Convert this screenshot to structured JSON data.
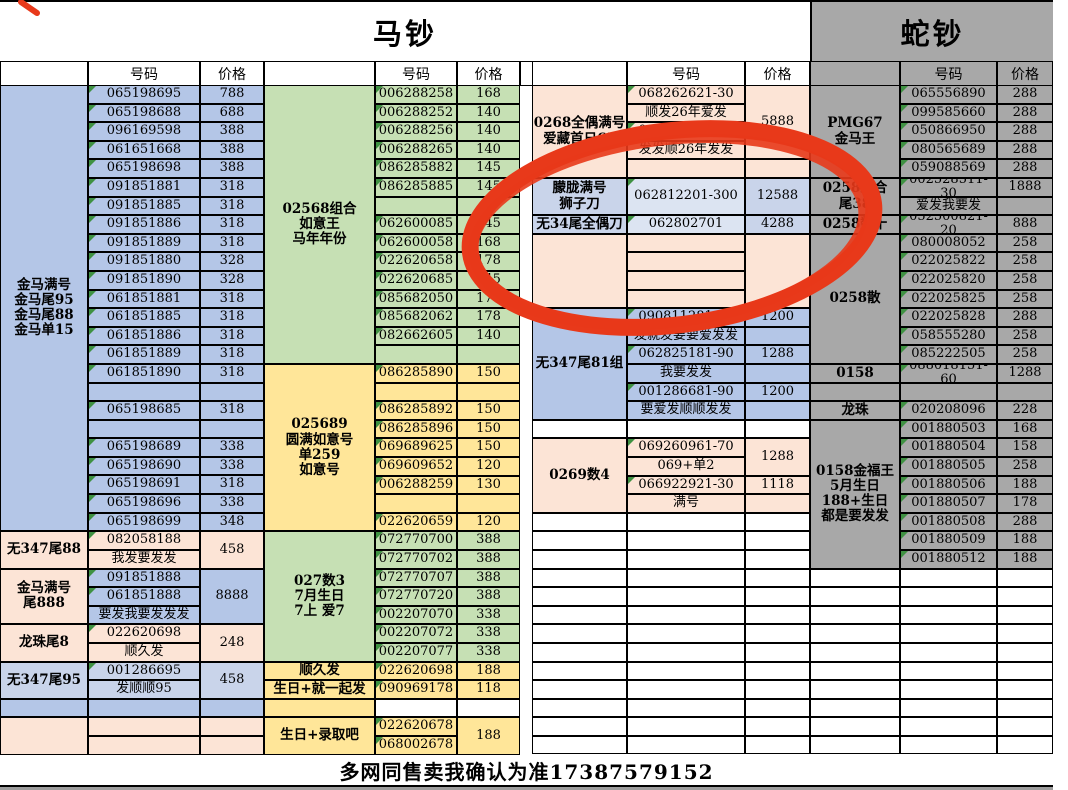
{
  "sheet": {
    "titles": {
      "horse": "马钞",
      "snake": "蛇钞"
    },
    "column_headers": {
      "number": "号码",
      "price": "价格"
    },
    "footer_note": "多网同售卖我确认为准17387579152",
    "annotation": {
      "type": "hand_drawn_red_circle",
      "color": "#e8391a"
    },
    "colors": {
      "blue": "#b4c6e7",
      "pale_blue": "#c9d4ea",
      "lighter_blue": "#dce4f2",
      "green": "#c6e0b4",
      "yellow": "#ffe699",
      "orange": "#fce4d6",
      "gray": "#a8a8a8",
      "marker_green": "#3f9142"
    },
    "groups": [
      {
        "id": "left",
        "widths": [
          88,
          112,
          64
        ],
        "blocks": [
          {
            "bg": "#b4c6e7",
            "label": [
              {
                "v": "金马满号\n金马尾95\n金马尾88\n金马单15",
                "s": 24
              }
            ],
            "num": [
              "065198695",
              "065198688",
              "096169598",
              "061651668",
              "065198698",
              "091851881",
              "091851885",
              "091851886",
              "091851889",
              "091851880",
              "091851890",
              "061851881",
              "061851885",
              "061851886",
              "061851889",
              "061851890",
              "",
              "065198685",
              "",
              "065198689",
              "065198690",
              "065198691",
              "065198696",
              "065198699"
            ],
            "price": [
              "788",
              "688",
              "388",
              "388",
              "388",
              "318",
              "318",
              "318",
              "318",
              "328",
              "328",
              "318",
              "318",
              "318",
              "318",
              "318",
              "",
              "318",
              "",
              "338",
              "338",
              "318",
              "338",
              "348"
            ]
          },
          {
            "bg": "#fce4d6",
            "label": [
              {
                "v": "无347尾88",
                "s": 2
              }
            ],
            "num": [
              "082058188",
              "我发要发发"
            ],
            "price": [
              {
                "v": "458",
                "s": 2
              }
            ]
          },
          {
            "bg": "#b4c6e7",
            "label": [
              {
                "v": "金马满号\n尾888",
                "s": 3,
                "bg": "#fce4d6"
              }
            ],
            "num": [
              "091851888",
              "061851888",
              "要发我要发发发"
            ],
            "price": [
              {
                "v": "8888",
                "s": 3
              }
            ]
          },
          {
            "bg": "#fce4d6",
            "label": [
              {
                "v": "龙珠尾8",
                "s": 2
              }
            ],
            "num": [
              "022620698",
              "顺久发"
            ],
            "price": [
              {
                "v": "248",
                "s": 2
              }
            ]
          },
          {
            "bg": "#c9d4ea",
            "label": [
              {
                "v": "无347尾95",
                "s": 2
              }
            ],
            "num": [
              "001286695",
              "发顺顺95"
            ],
            "price": [
              {
                "v": "458",
                "s": 2
              }
            ]
          },
          {
            "bg": "#b4c6e7",
            "label": [
              {
                "v": "",
                "s": 1
              }
            ],
            "num": [
              ""
            ],
            "price": [
              ""
            ]
          },
          {
            "bg": "#fce4d6",
            "label": [
              {
                "v": "",
                "s": 2
              }
            ],
            "num": [
              "",
              ""
            ],
            "price": [
              "",
              ""
            ]
          }
        ]
      },
      {
        "id": "mid-left",
        "widths": [
          111,
          82,
          63
        ],
        "blocks": [
          {
            "bg": "#c6e0b4",
            "label": [
              {
                "v": "02568组合\n如意王\n马年年份",
                "s": 15
              }
            ],
            "num": [
              "006288258",
              "006288252",
              "006288256",
              "006288265",
              "086285882",
              "086285885",
              "",
              "062600085",
              "062600058",
              "022620658",
              "022620685",
              "085682050",
              "085682062",
              "082662605",
              ""
            ],
            "price": [
              "168",
              "140",
              "140",
              "140",
              "145",
              "145",
              "",
              "145",
              "168",
              "178",
              "145",
              "178",
              "178",
              "140",
              ""
            ]
          },
          {
            "bg": "#ffe699",
            "label": [
              {
                "v": "025689\n圆满如意号\n单259\n如意号",
                "s": 9
              }
            ],
            "num": [
              "086285890",
              "",
              "086285892",
              "086285896",
              "069689625",
              "069609652",
              "006288259",
              "",
              "022620659"
            ],
            "price": [
              "150",
              "",
              "150",
              "150",
              "150",
              "120",
              "130",
              "",
              "120"
            ]
          },
          {
            "bg": "#c6e0b4",
            "label": [
              {
                "v": "027数3\n7月生日\n7上 爱7",
                "s": 7
              }
            ],
            "num": [
              "072770700",
              "072770702",
              "072770707",
              "072770720",
              "002207070",
              "002207072",
              "002207077"
            ],
            "price": [
              "388",
              "388",
              "388",
              "388",
              "338",
              "338",
              "338"
            ]
          },
          {
            "bg": "#ffe699",
            "label": [
              {
                "v": "顺久发",
                "s": 1
              }
            ],
            "num": [
              "022620698"
            ],
            "price": [
              "188"
            ]
          },
          {
            "bg": "#ffe699",
            "label": [
              {
                "v": "生日+就一起发",
                "s": 1
              }
            ],
            "num": [
              "090969178"
            ],
            "price": [
              "118"
            ]
          },
          {
            "bg": "#ffffff",
            "label": [
              {
                "v": "",
                "s": 1,
                "bg": "#ffe699"
              }
            ],
            "num": [
              ""
            ],
            "price": [
              ""
            ]
          },
          {
            "bg": "#ffe699",
            "label": [
              {
                "v": "生日+录取吧",
                "s": 2
              }
            ],
            "num": [
              "022620678",
              "068002678"
            ],
            "price": [
              {
                "v": "188",
                "s": 2
              }
            ]
          }
        ]
      },
      {
        "id": "middle",
        "widths": [
          95,
          118,
          65
        ],
        "blocks": [
          {
            "bg": "#fce4d6",
            "label": [
              {
                "v": "0268全偶满号\n爱藏首日65",
                "s": 5
              }
            ],
            "num": [
              "068262621-30",
              "顺发26年爱发",
              "068262721-30",
              "发发顺26年发发",
              ""
            ],
            "price": [
              {
                "v": "5888",
                "s": 4
              },
              {
                "v": "",
                "s": 1
              }
            ]
          },
          {
            "bg": "#c9d4ea",
            "label": [
              {
                "v": "朦胧满号\n狮子刀",
                "s": 2
              }
            ],
            "num": [
              {
                "v": "062812201-300",
                "s": 2,
                "bg": "#dce4f2"
              }
            ],
            "price": [
              {
                "v": "12588",
                "s": 2
              }
            ]
          },
          {
            "bg": "#c9d4ea",
            "label": [
              {
                "v": "无34尾全偶刀",
                "s": 1
              }
            ],
            "num": [
              {
                "v": "062802701",
                "bg": "#dce4f2"
              }
            ],
            "price": [
              "4288"
            ]
          },
          {
            "bg": "#fce4d6",
            "label": [
              {
                "v": "",
                "s": 4
              }
            ],
            "num": [
              "",
              "",
              "",
              ""
            ],
            "price": [
              {
                "v": "",
                "s": 4
              }
            ]
          },
          {
            "bg": "#b4c6e7",
            "label": [
              {
                "v": "无347尾81组",
                "s": 6
              }
            ],
            "num": [
              "090811281-90",
              "发就发要要爱发发",
              "062825181-90",
              "我要发发",
              "001286681-90",
              "要爱发顺顺发发"
            ],
            "price": [
              "1200",
              "",
              "1288",
              "",
              "1200",
              ""
            ]
          },
          {
            "bg": "#ffffff",
            "label": [
              {
                "v": "",
                "s": 1
              }
            ],
            "num": [
              ""
            ],
            "price": [
              ""
            ]
          },
          {
            "bg": "#fce4d6",
            "label": [
              {
                "v": "0269数4",
                "s": 4
              }
            ],
            "num": [
              "069260961-70",
              "069+单2",
              "066922921-30",
              "满号"
            ],
            "price": [
              {
                "v": "1288",
                "s": 2
              },
              {
                "v": "1118",
                "s": 1
              },
              {
                "v": "",
                "s": 1
              }
            ]
          },
          {
            "bg": "#ffffff",
            "label": [
              "",
              "",
              "",
              "",
              "",
              "",
              "",
              "",
              "",
              "",
              "",
              "",
              ""
            ],
            "num": [
              "",
              "",
              "",
              "",
              "",
              "",
              "",
              "",
              "",
              "",
              "",
              "",
              ""
            ],
            "price": [
              "",
              "",
              "",
              "",
              "",
              "",
              "",
              "",
              "",
              "",
              "",
              "",
              ""
            ]
          }
        ]
      },
      {
        "id": "right",
        "widths": [
          90,
          97,
          56
        ],
        "blocks": [
          {
            "bg": "#a8a8a8",
            "label": [
              {
                "v": "PMG67\n金马王",
                "s": 5
              }
            ],
            "num": [
              "065556890",
              "099585660",
              "050866950",
              "080565689",
              "059088569"
            ],
            "price": [
              "288",
              "288",
              "288",
              "288",
              "288"
            ]
          },
          {
            "bg": "#a8a8a8",
            "label": [
              {
                "v": "0258组合\n尾38",
                "s": 2
              }
            ],
            "num": [
              "002528511-30",
              "爱发我要发"
            ],
            "price": [
              "1888",
              ""
            ]
          },
          {
            "bg": "#a8a8a8",
            "label": [
              {
                "v": "0258数十",
                "s": 1
              }
            ],
            "num": [
              "052500821-20"
            ],
            "price": [
              "888"
            ]
          },
          {
            "bg": "#a8a8a8",
            "label": [
              {
                "v": "0258散",
                "s": 7
              }
            ],
            "num": [
              "080008052",
              "022025822",
              "022025820",
              "022025825",
              "022025828",
              "058555280",
              "085222505"
            ],
            "price": [
              "258",
              "258",
              "258",
              "258",
              "288",
              "258",
              "258"
            ]
          },
          {
            "bg": "#a8a8a8",
            "label": [
              {
                "v": "0158",
                "s": 1
              }
            ],
            "num": [
              "088018151-60"
            ],
            "price": [
              "1288"
            ]
          },
          {
            "bg": "#a8a8a8",
            "label": [
              {
                "v": "",
                "s": 1
              }
            ],
            "num": [
              ""
            ],
            "price": [
              ""
            ]
          },
          {
            "bg": "#a8a8a8",
            "label": [
              {
                "v": "龙珠",
                "s": 1
              }
            ],
            "num": [
              "020208096"
            ],
            "price": [
              "228"
            ]
          },
          {
            "bg": "#a8a8a8",
            "label": [
              {
                "v": "0158金福王\n5月生日\n188+生日\n都是要发发",
                "s": 8
              }
            ],
            "num": [
              "001880503",
              "001880504",
              "001880505",
              "001880506",
              "001880507",
              "001880508",
              "001880509",
              "001880512"
            ],
            "price": [
              "168",
              "158",
              "258",
              "188",
              "178",
              "288",
              "188",
              "188"
            ]
          },
          {
            "bg": "#ffffff",
            "label": [
              "",
              "",
              "",
              "",
              "",
              "",
              "",
              "",
              "",
              ""
            ],
            "num": [
              "",
              "",
              "",
              "",
              "",
              "",
              "",
              "",
              "",
              ""
            ],
            "price": [
              "",
              "",
              "",
              "",
              "",
              "",
              "",
              "",
              "",
              ""
            ]
          }
        ]
      }
    ]
  }
}
